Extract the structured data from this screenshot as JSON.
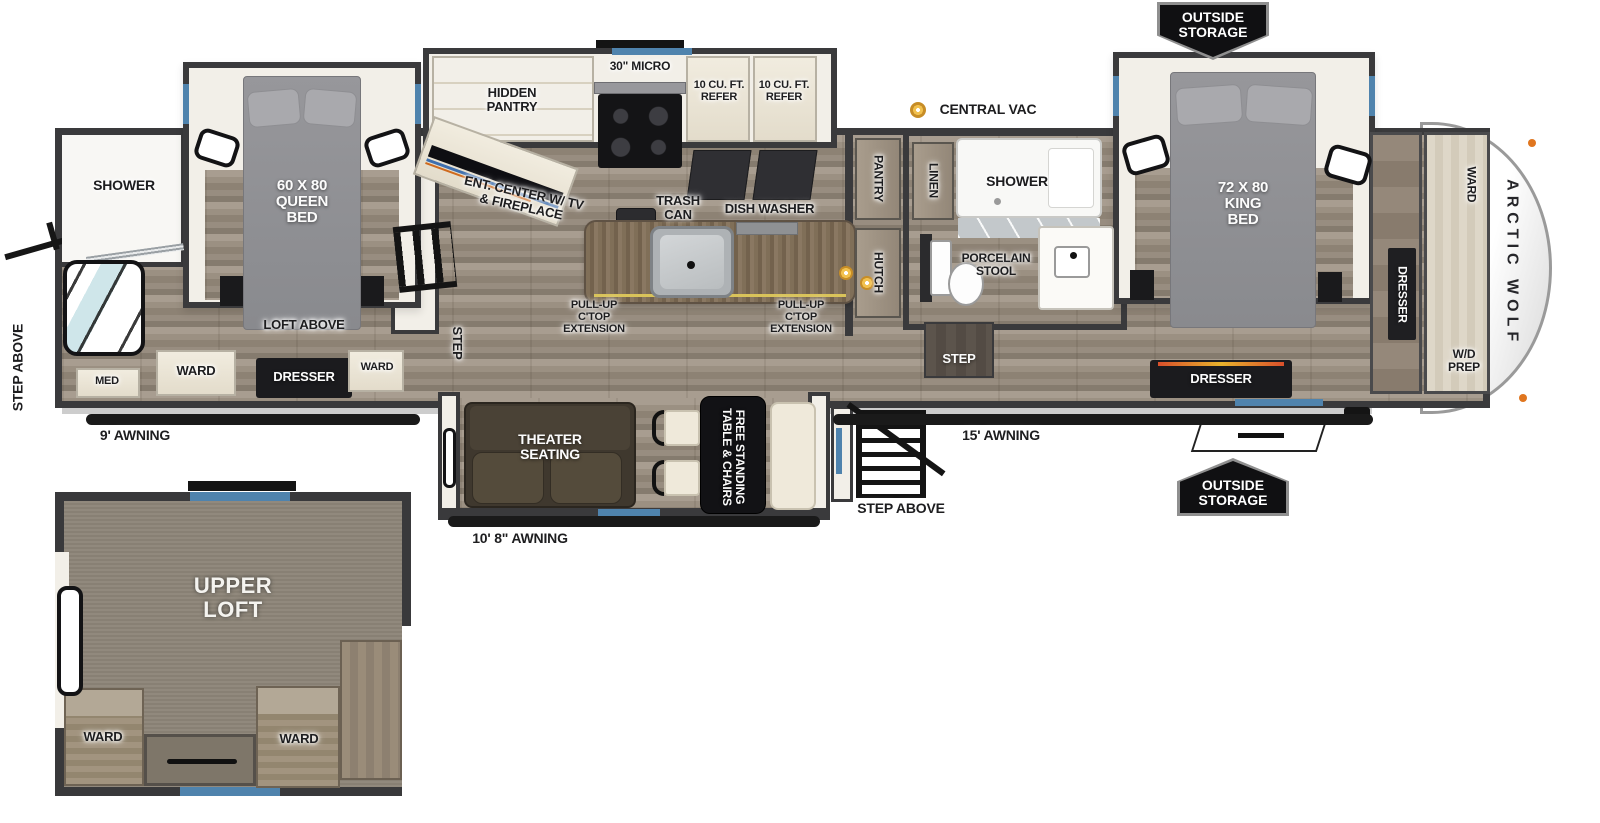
{
  "palette": {
    "wall": "#3a3a3c",
    "floor": "#9b9082",
    "carpet": "#8d8578",
    "accent_blue": "#4f83ad",
    "island_wood": "#7d6c56",
    "cabinet_cream": "#ece7da",
    "dark_fixture": "#1b1b1e",
    "vac_orange": "#e8a73a",
    "marker_orange": "#e0761f"
  },
  "exterior": {
    "brand": "ARCTIC WOLF",
    "step_above_left": "STEP ABOVE",
    "step_above_entry": "STEP ABOVE",
    "awning_rear": "9' AWNING",
    "awning_slide": "10' 8\" AWNING",
    "awning_main": "15' AWNING",
    "outside_storage_top": "OUTSIDE\nSTORAGE",
    "outside_storage_bottom": "OUTSIDE\nSTORAGE",
    "central_vac": "CENTRAL VAC"
  },
  "front_bedroom": {
    "shower": "SHOWER",
    "bed": "60 X 80\nQUEEN\nBED",
    "loft_above": "LOFT ABOVE",
    "ward_left": "WARD",
    "dresser": "DRESSER",
    "ward_right": "WARD",
    "med": "MED",
    "step": "STEP"
  },
  "kitchen": {
    "hidden_pantry": "HIDDEN\nPANTRY",
    "micro": "30\" MICRO",
    "refer_left": "10 CU. FT.\nREFER",
    "refer_right": "10 CU. FT.\nREFER",
    "ent_center": "ENT. CENTER W/ TV\n& FIREPLACE",
    "trash_can": "TRASH\nCAN",
    "dish_washer": "DISH WASHER",
    "pullup_left": "PULL-UP\nC'TOP\nEXTENSION",
    "pullup_right": "PULL-UP\nC'TOP\nEXTENSION"
  },
  "living_slide": {
    "theater": "THEATER\nSEATING",
    "dinette": "FREE STANDING\nTABLE & CHAIRS"
  },
  "bath": {
    "pantry": "PANTRY",
    "linen": "LINEN",
    "shower": "SHOWER",
    "hutch": "HUTCH",
    "stool": "PORCELAIN\nSTOOL",
    "step": "STEP"
  },
  "rear_bedroom": {
    "bed": "72 X 80\nKING\nBED",
    "dresser_side": "DRESSER",
    "dresser_front": "DRESSER",
    "ward": "WARD",
    "wd_prep": "W/D\nPREP"
  },
  "loft": {
    "title": "UPPER\nLOFT",
    "ward_left": "WARD",
    "ward_right": "WARD"
  }
}
